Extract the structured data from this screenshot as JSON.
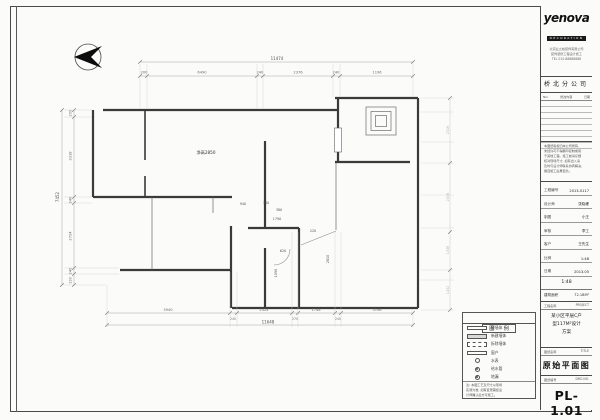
{
  "colors": {
    "line": "#3a3a3a",
    "dim": "#8a8a8a",
    "accent": "#1a1a1a"
  },
  "logo": {
    "brand": "yenova",
    "sub": "DECORATION",
    "lines": [
      "北京业之峰装饰有限公司",
      "装饰装修工程设计施工",
      "TEL 010-88888888"
    ]
  },
  "title_block": {
    "branch": "桥北分公司",
    "rev": {
      "no": "NO.",
      "content": "修改内容",
      "date": "日期"
    },
    "note_lines": [
      "本图纸版权归本公司所有,",
      "未经许可不得翻印复制或用",
      "于其他工程。施工前请仔细",
      "核对现场尺寸, 如有出入请",
      "及时与设计师联系协商解决,",
      "擅自施工后果自负。"
    ],
    "fields": [
      {
        "label": "工程编号",
        "value": "2013-0117"
      },
      {
        "label": "设计师",
        "value": "张晓峰"
      },
      {
        "label": "制图",
        "value": "小王"
      },
      {
        "label": "审核",
        "value": "李工"
      },
      {
        "label": "客户",
        "value": "王先生"
      },
      {
        "label": "比例",
        "value": "1:48"
      },
      {
        "label": "日期",
        "value": "2013.05"
      }
    ],
    "scale": "1:48",
    "area": {
      "label": "建筑面积",
      "value": "72.18M²"
    },
    "project": {
      "label": "工程名称",
      "en": "PROJECT",
      "lines": [
        "某小区平层C户",
        "型117M²设计",
        "方案"
      ]
    },
    "title": {
      "label": "图纸名称",
      "en": "TITLE",
      "value": "原始平面图"
    },
    "number": {
      "label": "图纸编号",
      "en": "DRG NO.",
      "value": "PL-1.01"
    }
  },
  "legend": {
    "title": "图 例",
    "walls": [
      {
        "label": "原墙体"
      },
      {
        "label": "新建墙体"
      },
      {
        "label": "拆除墙体"
      },
      {
        "label": "窗户"
      }
    ],
    "symbols": [
      {
        "label": "水表"
      },
      {
        "label": "给水管"
      },
      {
        "label": "地漏"
      }
    ],
    "note_lines": [
      "注: 本图工艺及尺寸以现场",
      "实测为准, 如有变更需经设",
      "计师确认后方可施工。"
    ]
  },
  "plan": {
    "room_label": "净高2850",
    "dims": {
      "top_overall": "11474",
      "top": [
        "200",
        "6490",
        "240",
        "2376",
        "240",
        "1196"
      ],
      "left_overall": "7452",
      "left": [
        "200",
        "3318",
        "240",
        "2724",
        "240",
        "130"
      ],
      "bottom_overall": "11648",
      "bottom": [
        "3940",
        "2324",
        "1748",
        "3198"
      ],
      "bottom_small": [
        "240",
        "270",
        "240"
      ],
      "right": [
        "2316",
        "2306",
        "1338",
        "1432"
      ],
      "interior": [
        "940",
        "740",
        "380",
        "1790",
        "220",
        "620",
        "1090",
        "2810"
      ]
    }
  }
}
